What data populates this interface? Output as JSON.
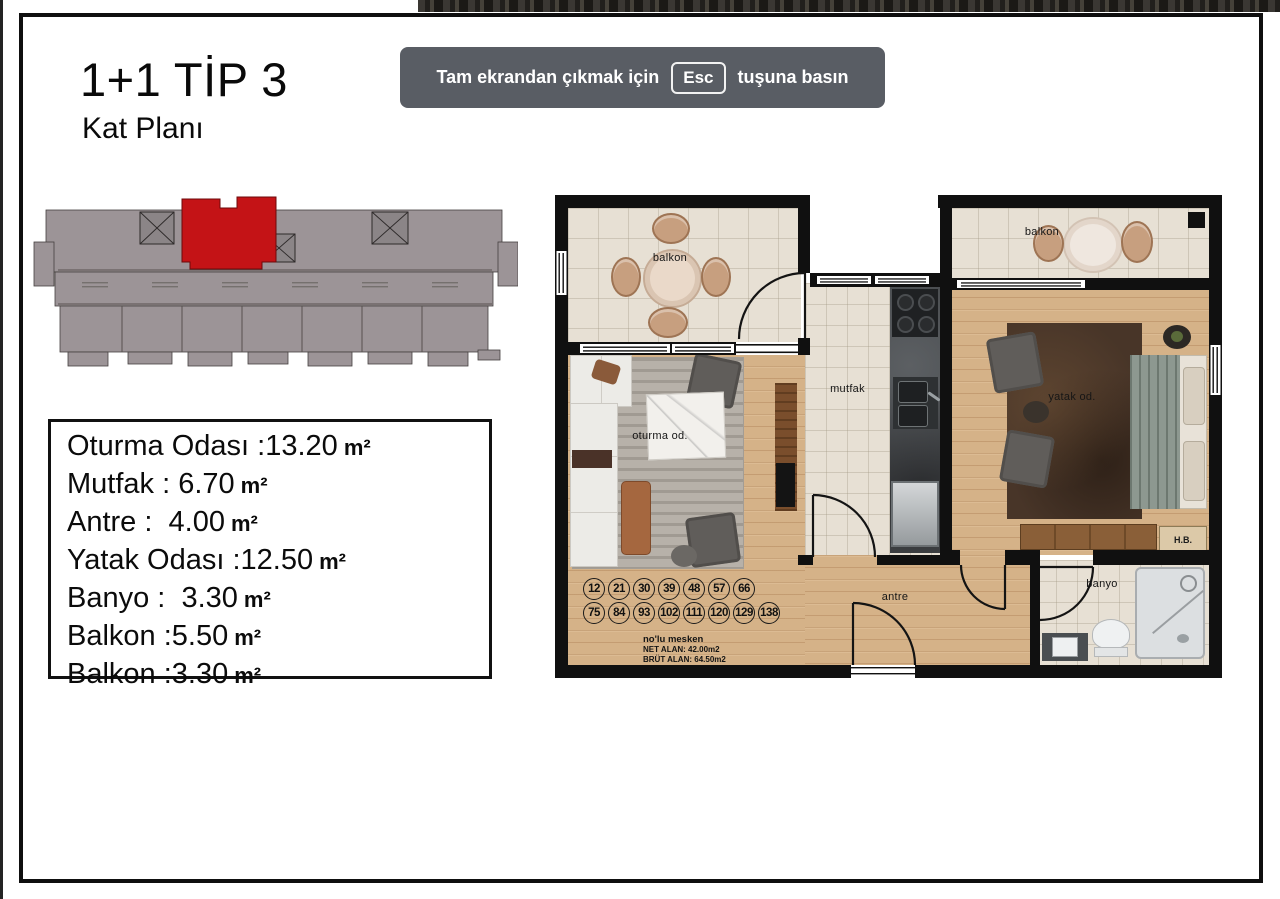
{
  "page": {
    "title": "1+1 TİP 3",
    "subtitle": "Kat Planı"
  },
  "banner": {
    "before": "Tam ekrandan çıkmak için",
    "key": "Esc",
    "after": "tuşuna basın"
  },
  "room_list": {
    "items": [
      {
        "label": "Oturma Odası :",
        "value": "13.20",
        "unit": "m²"
      },
      {
        "label": "Mutfak : ",
        "value": "6.70",
        "unit": "m²"
      },
      {
        "label": "Antre :  ",
        "value": "4.00",
        "unit": "m²"
      },
      {
        "label": "Yatak Odası :",
        "value": "12.50",
        "unit": "m²"
      },
      {
        "label": "Banyo :  ",
        "value": "3.30",
        "unit": "m²"
      },
      {
        "label": "Balkon :",
        "value": "5.50",
        "unit": "m²"
      },
      {
        "label": "Balkon :",
        "value": "3.30",
        "unit": "m²"
      }
    ]
  },
  "plan": {
    "labels": {
      "balcony_left": "balkon",
      "balcony_right": "balkon",
      "living": "oturma od.",
      "kitchen": "mutfak",
      "bedroom": "yatak od.",
      "hall": "antre",
      "bath": "banyo",
      "hb": "H.B."
    },
    "numbers": [
      "12",
      "21",
      "30",
      "39",
      "48",
      "57",
      "66",
      "75",
      "84",
      "93",
      "102",
      "111",
      "120",
      "129",
      "138"
    ],
    "info": {
      "title": "no'lu mesken",
      "net": "NET ALAN: 42.00m2",
      "brut": "BRÜT ALAN: 64.50m2"
    }
  },
  "colors": {
    "highlight_red": "#c41316",
    "banner_bg": "#595d64"
  }
}
